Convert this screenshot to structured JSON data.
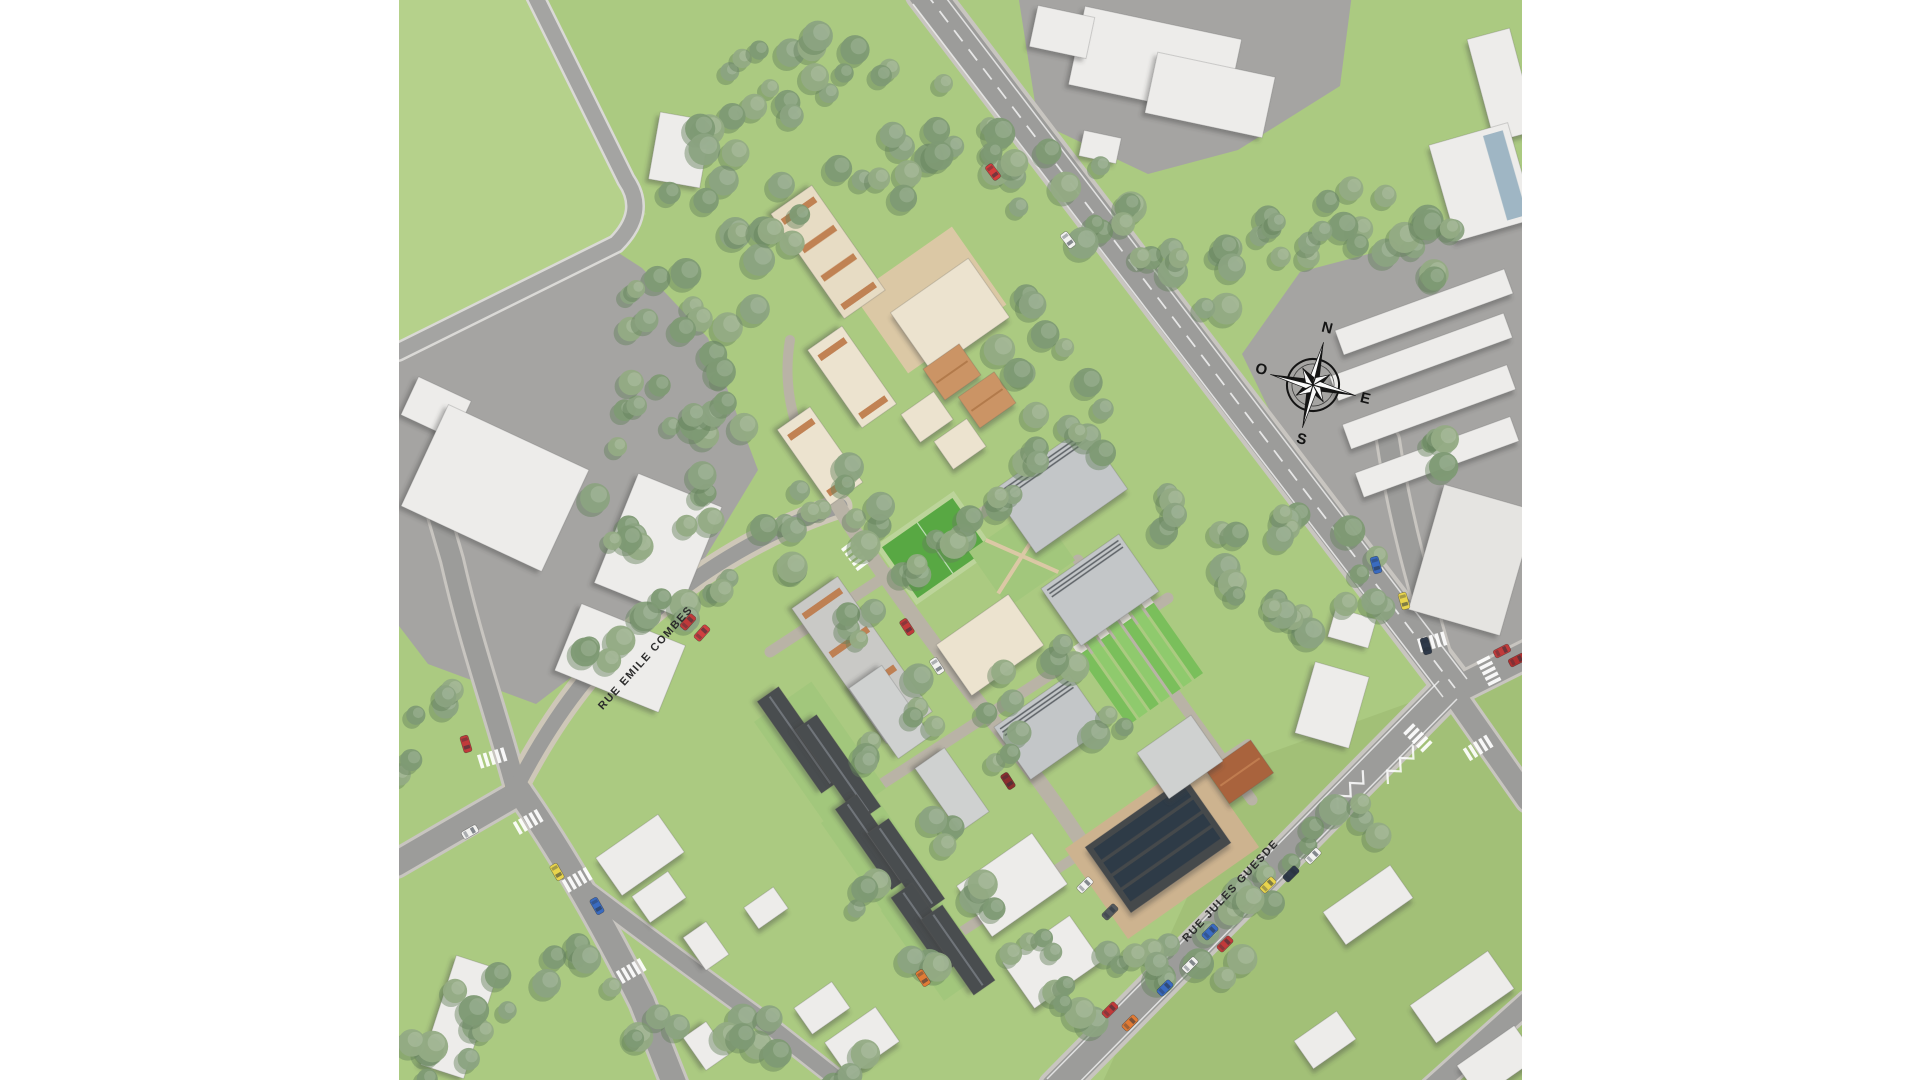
{
  "meta": {
    "description": "Aerial architectural masterplan rendering of a new housing development between Rue Emile Combes and Rue Jules Guesde"
  },
  "canvas": {
    "w": 1920,
    "h": 1080,
    "bg": "#ffffff",
    "content_x": 399,
    "content_w": 1123
  },
  "palette": {
    "grass": "#abca81",
    "grass_light": "#b6d28d",
    "grass_dark_overlay": "rgba(120,150,80,0.18)",
    "pavement": "#a5a4a2",
    "road": "#9c9c9a",
    "road_casing": "#c8c5c0",
    "narrow_road": "#a4a4a2",
    "narrow_casing": "#dad9d6",
    "sidewalk_tan": "#cec7b8",
    "site_street": "#b9b3a6",
    "white_bld": "#edecea",
    "pale_bld": "#e5e4e1",
    "cream": "#ece3cf",
    "cream2": "#e7dcc4",
    "terracotta": "#bd7a48",
    "terra_roof": "#cb9465",
    "gray_roof": "#c3c6c8",
    "gray_roof2": "#cfd1d0",
    "ridge": "#5b6165",
    "charcoal": "#4a4d4f",
    "charcoal_mid": "#70757a",
    "pv_dark": "#2e3a46",
    "rust": "#a9643c",
    "glass": "#9fb6c4",
    "dirt": "#cdb38f",
    "plaza": "#dbc8a5",
    "field_green": "#58a843",
    "field_border": "#bcd49a",
    "garden_green": "#a2c77c",
    "allot_a": "#7abf5b",
    "allot_b": "#8fca6d",
    "allot_cap": "#e8e5dc",
    "tree_body": "#8ba381",
    "tree_body2": "#93ab84",
    "tree_body3": "#7e9a74",
    "tree_shadow": "#64805c",
    "marking_white": "#ffffff",
    "label_color": "#2b2b2b"
  },
  "labels": {
    "compass": {
      "n": "N",
      "e": "E",
      "s": "S",
      "o": "O"
    }
  },
  "street_labels": [
    {
      "text": "RUE EMILE COMBES",
      "x": 648,
      "y": 660,
      "rot": -48,
      "size": 11
    },
    {
      "text": "RUE JULES GUESDE",
      "x": 1233,
      "y": 893,
      "rot": -47,
      "size": 11
    }
  ],
  "compass": {
    "x": 1313,
    "y": 385,
    "rot": 14,
    "ring_r": 26,
    "long_spike": 44,
    "short_spike": 20,
    "letter_off": 58,
    "letter_size": 15
  },
  "zones": [
    {
      "name": "campus-pavement",
      "pts": "1018,-6 1352,-6 1340,86 1238,150 1148,174 1038,122",
      "fill": "pavement"
    },
    {
      "name": "left-industrial-yard",
      "pts": "398,358 614,250 642,268 708,338 758,470 700,566 612,646 536,704 428,664 396,622",
      "fill": "pavement"
    },
    {
      "name": "right-industrial-yard",
      "pts": "1242,354 1300,272 1452,232 1528,208 1528,642 1458,676 1280,432",
      "fill": "pavement"
    }
  ],
  "green_patches": [
    {
      "pts": "396,-8 528,-8 622,182 646,214 614,248 396,356",
      "fill": "grass_light",
      "op": 0.85
    },
    {
      "pts": "1250,760 1528,660 1528,1088 1100,1088",
      "fill": "grass_dark_overlay",
      "op": 1
    }
  ],
  "roads": [
    {
      "name": "main-avenue",
      "d": "M925,-8 L1455,688",
      "w": 34,
      "cw": 42
    },
    {
      "name": "rue-jules-guesde",
      "d": "M1448,690 L1056,1088",
      "w": 30,
      "cw": 38
    },
    {
      "name": "east-leg",
      "d": "M1452,692 L1528,654",
      "w": 26,
      "cw": 32
    },
    {
      "name": "southeast-leg",
      "d": "M1458,700 L1528,800",
      "w": 22,
      "cw": 28
    },
    {
      "name": "north-leg",
      "d": "M1448,684 C1420,590 1400,520 1388,440",
      "w": 20,
      "cw": 26
    },
    {
      "name": "bent-lane",
      "d": "M533,-8 L626,180 Q648,212 616,244 L398,352",
      "w": 15,
      "cw": 20,
      "rc": "narrow_road",
      "cc": "narrow_casing"
    },
    {
      "name": "west-junction-up",
      "d": "M516,788 C492,700 472,648 452,560 L436,505",
      "w": 20,
      "cw": 26
    },
    {
      "name": "west-junction-left",
      "d": "M520,792 L396,864",
      "w": 24,
      "cw": 30
    },
    {
      "name": "west-junction-down",
      "d": "M517,788 C562,852 602,922 642,1002 L676,1088",
      "w": 24,
      "cw": 30
    },
    {
      "name": "south-branch",
      "d": "M576,882 C642,932 704,978 762,1020 L846,1086",
      "w": 16,
      "cw": 21
    },
    {
      "name": "corner-road",
      "d": "M1432,1088 L1528,1002",
      "w": 20,
      "cw": 26
    },
    {
      "name": "rue-emile-combes",
      "d": "M515,790 C558,706 606,646 678,592 C730,552 790,522 840,506",
      "w": 15,
      "cw": 25,
      "cc": "sidewalk_tan"
    }
  ],
  "site_streets": [
    {
      "name": "site-spine",
      "d": "M838,505 C870,560 960,680 1000,730 C1040,780 1075,830 1098,868",
      "w": 15
    },
    {
      "name": "site-cross-1",
      "d": "M770,652 L1078,450",
      "w": 11
    },
    {
      "name": "site-cross-2",
      "d": "M865,795 L1168,598",
      "w": 11
    },
    {
      "name": "site-cross-3",
      "d": "M952,938 L1248,744",
      "w": 10
    },
    {
      "name": "site-spine-2",
      "d": "M1078,560 L1252,800",
      "w": 11
    },
    {
      "name": "site-north-edge",
      "d": "M838,505 C800,450 780,400 790,340",
      "w": 10
    }
  ],
  "ground_details": {
    "plaza": {
      "x": 930,
      "y": 300,
      "w": 120,
      "h": 95,
      "rot": -35
    },
    "dirt": {
      "x": 1162,
      "y": 848,
      "w": 160,
      "h": 110,
      "rot": -35
    },
    "lawns": [
      [
        820,
        755,
        130,
        70,
        55
      ],
      [
        880,
        855,
        120,
        60,
        55
      ],
      [
        935,
        940,
        110,
        55,
        55
      ]
    ],
    "field": {
      "x": 935,
      "y": 548,
      "w": 96,
      "h": 72,
      "rot": -35
    },
    "garden": {
      "x": 1022,
      "y": 556,
      "w": 82,
      "h": 68,
      "rot": -35
    },
    "allotments": {
      "x": 1138,
      "y": 660,
      "rot": -35,
      "strips": 7,
      "strip_w": 10.5,
      "gap": 13.5,
      "len": 96
    }
  },
  "buildings": [
    [
      680,
      150,
      52,
      68,
      10,
      "w"
    ],
    [
      1155,
      62,
      160,
      80,
      12,
      "w"
    ],
    [
      1210,
      95,
      120,
      62,
      12,
      "w"
    ],
    [
      1062,
      32,
      58,
      42,
      12,
      "w"
    ],
    [
      1100,
      147,
      38,
      26,
      12,
      "w"
    ],
    [
      1502,
      85,
      44,
      106,
      -15,
      "w"
    ],
    [
      436,
      408,
      58,
      42,
      25,
      "w"
    ],
    [
      495,
      488,
      155,
      112,
      25,
      "w"
    ],
    [
      658,
      545,
      90,
      118,
      22,
      "w"
    ],
    [
      620,
      658,
      112,
      72,
      22,
      "w"
    ],
    [
      640,
      855,
      76,
      46,
      -35,
      "w"
    ],
    [
      460,
      1017,
      45,
      115,
      18,
      "w"
    ],
    [
      659,
      897,
      44,
      32,
      -35,
      "w"
    ],
    [
      706,
      946,
      40,
      28,
      55,
      "w"
    ],
    [
      766,
      908,
      36,
      26,
      -35,
      "w"
    ],
    [
      822,
      1008,
      46,
      32,
      -35,
      "w"
    ],
    [
      706,
      1046,
      40,
      28,
      55,
      "w"
    ],
    [
      1012,
      885,
      92,
      62,
      -35,
      "w"
    ],
    [
      1052,
      962,
      82,
      56,
      -35,
      "w"
    ],
    [
      862,
      1042,
      62,
      42,
      -35,
      "w"
    ],
    [
      1332,
      705,
      56,
      74,
      16,
      "w"
    ],
    [
      1352,
      628,
      42,
      30,
      16,
      "w"
    ],
    [
      1472,
      560,
      95,
      130,
      16,
      "pale"
    ],
    [
      1368,
      905,
      82,
      40,
      -35,
      "w"
    ],
    [
      1462,
      997,
      95,
      46,
      -35,
      "w"
    ],
    [
      1325,
      1040,
      52,
      34,
      -35,
      "w"
    ],
    [
      1497,
      1062,
      70,
      40,
      -35,
      "w"
    ],
    [
      1424,
      312,
      180,
      26,
      -20,
      "w"
    ],
    [
      1421,
      357,
      185,
      26,
      -20,
      "w"
    ],
    [
      1429,
      407,
      175,
      26,
      -20,
      "w"
    ],
    [
      1437,
      457,
      165,
      26,
      -20,
      "w"
    ],
    [
      1482,
      182,
      82,
      100,
      -16,
      "glass"
    ],
    [
      828,
      252,
      128,
      50,
      55,
      "terraRows"
    ],
    [
      950,
      315,
      95,
      72,
      -35,
      "cream"
    ],
    [
      952,
      372,
      44,
      38,
      -35,
      "terraRoof"
    ],
    [
      987,
      400,
      44,
      38,
      -35,
      "terraRoof"
    ],
    [
      927,
      417,
      40,
      34,
      -35,
      "cream"
    ],
    [
      960,
      444,
      40,
      34,
      -35,
      "cream"
    ],
    [
      852,
      377,
      95,
      42,
      55,
      "creamT"
    ],
    [
      820,
      456,
      92,
      40,
      55,
      "creamT"
    ],
    [
      1060,
      490,
      112,
      76,
      -35,
      "grayRidge"
    ],
    [
      1100,
      590,
      95,
      70,
      -35,
      "grayRidge"
    ],
    [
      990,
      645,
      88,
      62,
      -35,
      "cream"
    ],
    [
      862,
      660,
      165,
      56,
      55,
      "grayTerra"
    ],
    [
      1050,
      727,
      92,
      64,
      -35,
      "grayRidge"
    ],
    [
      800,
      740,
      112,
      26,
      55,
      "charcoal"
    ],
    [
      838,
      768,
      112,
      26,
      55,
      "charcoal"
    ],
    [
      874,
      842,
      98,
      26,
      55,
      "charcoal"
    ],
    [
      906,
      866,
      98,
      26,
      55,
      "charcoal"
    ],
    [
      928,
      928,
      92,
      26,
      55,
      "charcoal"
    ],
    [
      958,
      950,
      92,
      26,
      55,
      "charcoal"
    ],
    [
      890,
      712,
      86,
      40,
      55,
      "grayLight"
    ],
    [
      952,
      790,
      78,
      36,
      55,
      "grayLight"
    ],
    [
      1158,
      845,
      122,
      80,
      -35,
      "pv"
    ],
    [
      1240,
      772,
      54,
      40,
      -35,
      "rust"
    ],
    [
      1180,
      757,
      66,
      56,
      -35,
      "grayLight"
    ]
  ],
  "tree_clusters": [
    [
      760,
      85,
      55,
      9
    ],
    [
      845,
      62,
      48,
      8
    ],
    [
      700,
      165,
      45,
      7
    ],
    [
      775,
      215,
      48,
      8
    ],
    [
      655,
      300,
      45,
      7
    ],
    [
      722,
      335,
      45,
      7
    ],
    [
      645,
      420,
      42,
      6
    ],
    [
      705,
      435,
      40,
      6
    ],
    [
      625,
      520,
      40,
      6
    ],
    [
      688,
      500,
      36,
      5
    ],
    [
      945,
      130,
      52,
      8
    ],
    [
      1015,
      172,
      45,
      7
    ],
    [
      878,
      172,
      42,
      6
    ],
    [
      1090,
      205,
      45,
      6
    ],
    [
      1155,
      235,
      42,
      6
    ],
    [
      1215,
      280,
      45,
      7
    ],
    [
      1275,
      255,
      40,
      6
    ],
    [
      1330,
      215,
      38,
      6
    ],
    [
      1392,
      232,
      38,
      6
    ],
    [
      1452,
      248,
      36,
      5
    ],
    [
      1030,
      330,
      45,
      7
    ],
    [
      1072,
      420,
      45,
      7
    ],
    [
      1005,
      472,
      40,
      6
    ],
    [
      955,
      520,
      30,
      4
    ],
    [
      622,
      642,
      40,
      6
    ],
    [
      698,
      602,
      40,
      6
    ],
    [
      772,
      552,
      36,
      5
    ],
    [
      825,
      482,
      34,
      5
    ],
    [
      578,
      978,
      40,
      6
    ],
    [
      492,
      992,
      42,
      6
    ],
    [
      435,
      1062,
      36,
      5
    ],
    [
      760,
      1052,
      40,
      6
    ],
    [
      842,
      1072,
      36,
      5
    ],
    [
      662,
      1035,
      30,
      4
    ],
    [
      880,
      522,
      28,
      4
    ],
    [
      902,
      575,
      24,
      3
    ],
    [
      862,
      620,
      26,
      4
    ],
    [
      930,
      700,
      28,
      4
    ],
    [
      992,
      692,
      24,
      3
    ],
    [
      1012,
      748,
      24,
      3
    ],
    [
      876,
      762,
      24,
      3
    ],
    [
      935,
      832,
      24,
      3
    ],
    [
      992,
      892,
      24,
      3
    ],
    [
      1035,
      952,
      28,
      4
    ],
    [
      922,
      955,
      24,
      3
    ],
    [
      868,
      902,
      24,
      3
    ],
    [
      1062,
      660,
      22,
      3
    ],
    [
      1105,
      722,
      22,
      3
    ],
    [
      1200,
      962,
      45,
      7
    ],
    [
      1272,
      895,
      45,
      7
    ],
    [
      1342,
      832,
      40,
      6
    ],
    [
      1128,
      952,
      36,
      5
    ],
    [
      1075,
      1002,
      36,
      5
    ],
    [
      1312,
      532,
      38,
      6
    ],
    [
      1362,
      585,
      34,
      5
    ],
    [
      1292,
      635,
      30,
      4
    ],
    [
      1435,
      455,
      28,
      4
    ],
    [
      1180,
      515,
      30,
      4
    ],
    [
      1228,
      560,
      30,
      4
    ],
    [
      1262,
      605,
      28,
      4
    ],
    [
      430,
      700,
      28,
      4
    ],
    [
      408,
      752,
      26,
      3
    ]
  ],
  "cars": [
    [
      "#d43c3c",
      993,
      172,
      53
    ],
    [
      "#f2f2f0",
      1068,
      240,
      53
    ],
    [
      "#c03a3a",
      688,
      622,
      -48
    ],
    [
      "#d04040",
      702,
      633,
      -48
    ],
    [
      "#c03a3a",
      466,
      744,
      73
    ],
    [
      "#e8d44d",
      557,
      872,
      60
    ],
    [
      "#3a6bc0",
      597,
      906,
      60
    ],
    [
      "#f0f0ee",
      470,
      832,
      -30
    ],
    [
      "#c03a3a",
      907,
      627,
      57
    ],
    [
      "#f2f2f0",
      937,
      666,
      57
    ],
    [
      "#e07b35",
      923,
      978,
      57
    ],
    [
      "#8a2f2f",
      1008,
      781,
      57
    ],
    [
      "#3a6bc0",
      1376,
      565,
      74
    ],
    [
      "#e8d44d",
      1404,
      601,
      74
    ],
    [
      "#2f3a4a",
      1426,
      646,
      74
    ],
    [
      "#c03a3a",
      1502,
      651,
      -27
    ],
    [
      "#b03030",
      1517,
      660,
      -27
    ],
    [
      "#f2f2f0",
      1085,
      885,
      -45
    ],
    [
      "#555a5e",
      1110,
      912,
      -45
    ],
    [
      "#c03a3a",
      1110,
      1010,
      -45
    ],
    [
      "#e07b35",
      1130,
      1023,
      -45
    ],
    [
      "#3a6bc0",
      1210,
      932,
      -45
    ],
    [
      "#c03a3a",
      1225,
      944,
      -45
    ],
    [
      "#f2f2f0",
      1190,
      965,
      -45
    ],
    [
      "#3a6bc0",
      1165,
      988,
      -45
    ],
    [
      "#e8d44d",
      1268,
      885,
      -45
    ],
    [
      "#2f3a4a",
      1291,
      874,
      -45
    ],
    [
      "#f2f2f0",
      1313,
      856,
      -45
    ]
  ],
  "markings": {
    "center_lines": [
      {
        "d": "M925,-8 L1455,688",
        "dash": "14 10"
      }
    ],
    "edge_lines": [
      [
        937,
        -14,
        1467,
        679
      ],
      [
        913,
        4,
        1443,
        697
      ],
      [
        1439,
        681,
        1047,
        1079
      ],
      [
        1457,
        699,
        1065,
        1097
      ]
    ],
    "crosswalks": [
      [
        492,
        758,
        73
      ],
      [
        528,
        822,
        60
      ],
      [
        577,
        880,
        60
      ],
      [
        631,
        971,
        60
      ],
      [
        855,
        556,
        -37
      ],
      [
        1432,
        642,
        74
      ],
      [
        1489,
        671,
        -27
      ],
      [
        1418,
        738,
        -45
      ],
      [
        1478,
        748,
        58
      ]
    ],
    "zigzags": [
      [
        1350,
        790,
        -45
      ],
      [
        1400,
        765,
        -45
      ]
    ]
  }
}
